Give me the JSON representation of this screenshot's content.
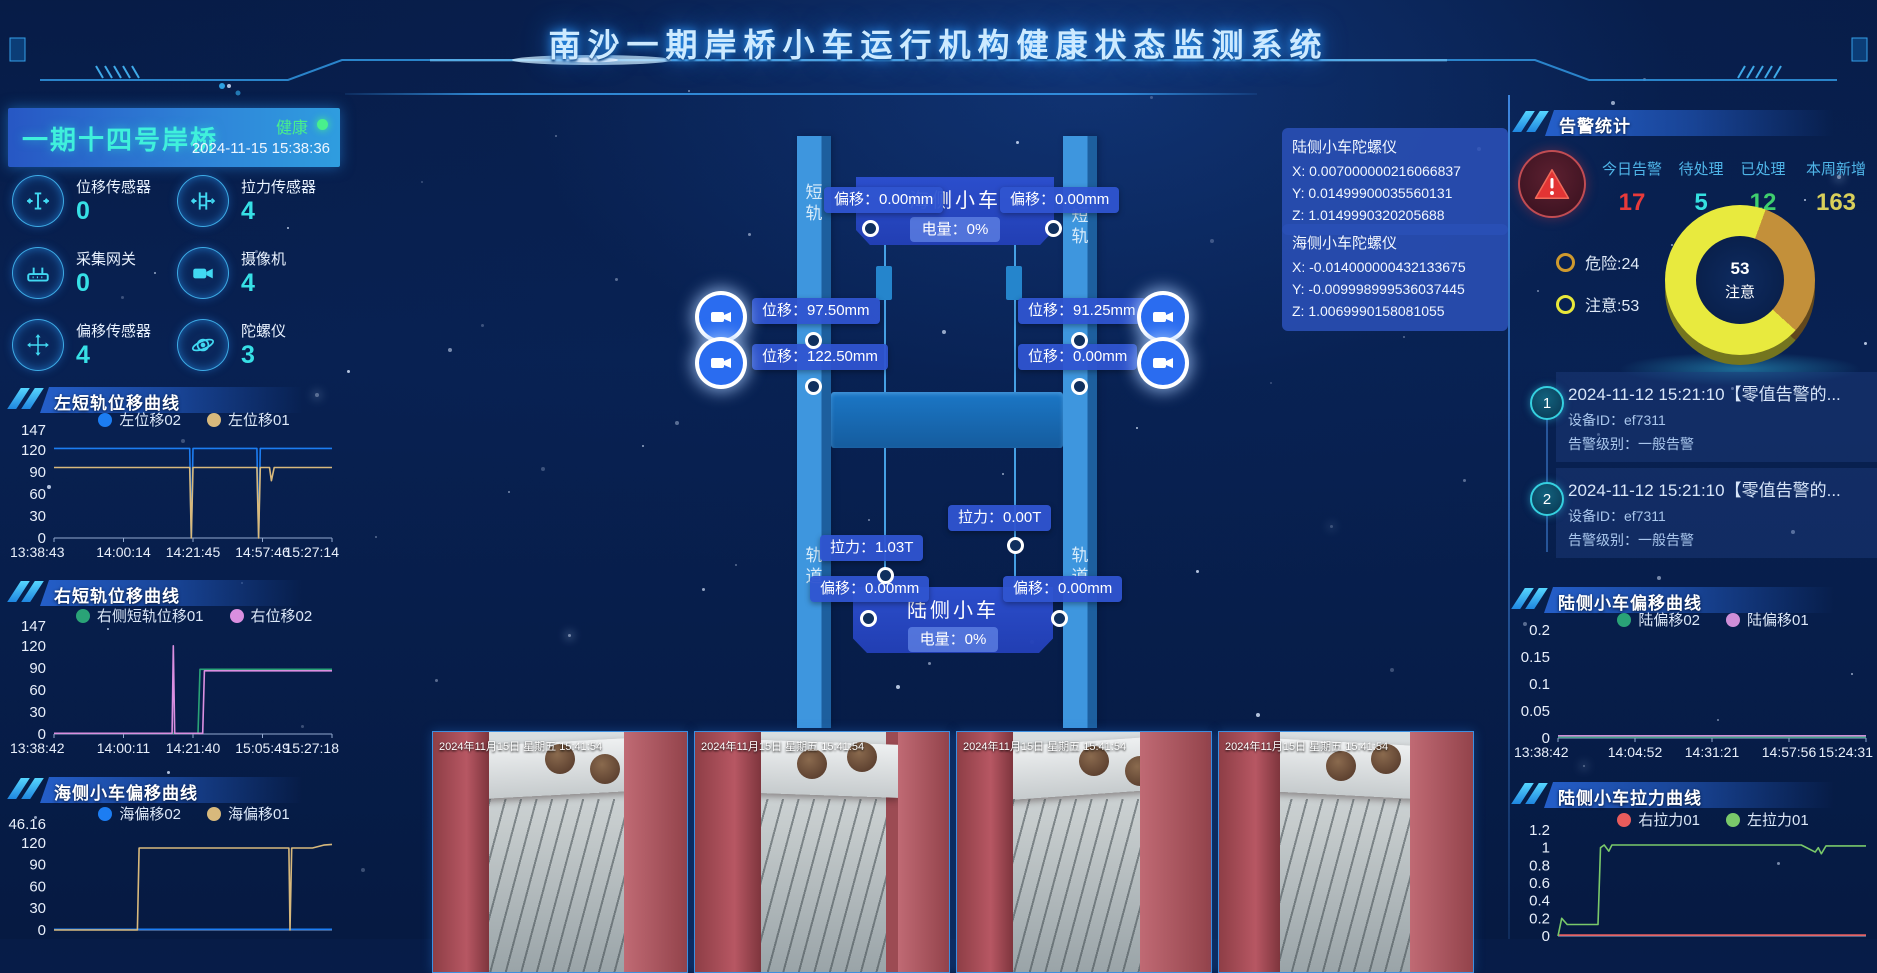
{
  "header": {
    "title": "南沙一期岸桥小车运行机构健康状态监测系统"
  },
  "crane": {
    "name": "一期十四号岸桥",
    "status": "健康",
    "timestamp": "2024-11-15 15:38:36",
    "sensors": [
      {
        "icon": "displacement-sensor-icon",
        "label": "位移传感器",
        "value": "0"
      },
      {
        "icon": "tension-sensor-icon",
        "label": "拉力传感器",
        "value": "4"
      },
      {
        "icon": "gateway-icon",
        "label": "采集网关",
        "value": "0"
      },
      {
        "icon": "camera-icon",
        "label": "摄像机",
        "value": "4"
      },
      {
        "icon": "offset-sensor-icon",
        "label": "偏移传感器",
        "value": "4"
      },
      {
        "icon": "gyroscope-icon",
        "label": "陀螺仪",
        "value": "3"
      }
    ]
  },
  "schematic": {
    "rail_short_label": "短\n轨",
    "rail_track_label": "轨\n道",
    "sea_trolley": {
      "name": "海侧小车",
      "battery": "电量：0%",
      "offset_left": "偏移：0.00mm",
      "offset_right": "偏移：0.00mm"
    },
    "land_trolley": {
      "name": "陆侧小车",
      "battery": "电量：0%",
      "offset_left": "偏移：0.00mm",
      "offset_right": "偏移：0.00mm"
    },
    "displacement": {
      "left_upper": "位移：97.50mm",
      "left_lower": "位移：122.50mm",
      "right_upper": "位移：91.25mm",
      "right_lower": "位移：0.00mm"
    },
    "tension": {
      "right": "拉力：0.00T",
      "left": "拉力：1.03T"
    },
    "gyros": [
      {
        "title": "陆侧小车陀螺仪",
        "x": "X:  0.007000000216066837",
        "y": "Y:  0.01499900035560131",
        "z": "Z:  1.0149990320205688"
      },
      {
        "title": "海侧小车陀螺仪",
        "x": "X:  -0.014000000432133675",
        "y": "Y:  -0.009998999536037445",
        "z": "Z:  1.0069990158081055"
      }
    ]
  },
  "alarms": {
    "title": "告警统计",
    "stats": [
      {
        "label": "今日告警",
        "value": "17",
        "color": "#e83a3a"
      },
      {
        "label": "待处理",
        "value": "5",
        "color": "#35e0e0"
      },
      {
        "label": "已处理",
        "value": "12",
        "color": "#3fcf6e"
      },
      {
        "label": "本周新增",
        "value": "163",
        "color": "#d8cf5a"
      }
    ],
    "items": [
      {
        "no": "1",
        "title": "2024-11-12 15:21:10【零值告警的...",
        "device": "设备ID：ef7311",
        "level": "告警级别：一般告警"
      },
      {
        "no": "2",
        "title": "2024-11-12 15:21:10【零值告警的...",
        "device": "设备ID：ef7311",
        "level": "告警级别：一般告警"
      }
    ]
  },
  "cameras": [
    {
      "timestamp": "2024年11月15日 星期五 15:41:54"
    },
    {
      "timestamp": "2024年11月15日 星期五 15:41:54"
    },
    {
      "timestamp": "2024年11月15日 星期五 15:41:54"
    },
    {
      "timestamp": "2024年11月15日 星期五 15:41:54"
    }
  ],
  "chart_data": [
    {
      "type": "line",
      "title": "左短轨位移曲线",
      "ylim": [
        0,
        147
      ],
      "yticks": [
        "147",
        "120",
        "90",
        "60",
        "30",
        "0"
      ],
      "xticks": [
        "13:38:43",
        "14:00:14",
        "14:21:45",
        "14:57:46",
        "15:27:14"
      ],
      "series": [
        {
          "name": "左位移02",
          "color": "#1c7df2",
          "points": [
            [
              0,
              122
            ],
            [
              0.488,
              122
            ],
            [
              0.494,
              2
            ],
            [
              0.5,
              122
            ],
            [
              0.73,
              122
            ],
            [
              0.736,
              2
            ],
            [
              0.742,
              122
            ],
            [
              1,
              122
            ]
          ]
        },
        {
          "name": "左位移01",
          "color": "#d8b97c",
          "points": [
            [
              0,
              96
            ],
            [
              0.488,
              96
            ],
            [
              0.494,
              0
            ],
            [
              0.5,
              96
            ],
            [
              0.73,
              96
            ],
            [
              0.736,
              0
            ],
            [
              0.742,
              96
            ],
            [
              0.775,
              96
            ],
            [
              0.782,
              78
            ],
            [
              0.792,
              96
            ],
            [
              1,
              96
            ]
          ]
        }
      ]
    },
    {
      "type": "line",
      "title": "右短轨位移曲线",
      "ylim": [
        0,
        147
      ],
      "yticks": [
        "147",
        "120",
        "90",
        "60",
        "30",
        "0"
      ],
      "xticks": [
        "13:38:42",
        "14:00:11",
        "14:21:40",
        "15:05:49",
        "15:27:18"
      ],
      "series": [
        {
          "name": "右侧短轨位移01",
          "color": "#2aa377",
          "points": [
            [
              0,
              1
            ],
            [
              0.518,
              1
            ],
            [
              0.525,
              88
            ],
            [
              1,
              88
            ]
          ]
        },
        {
          "name": "右位移02",
          "color": "#da8fe0",
          "points": [
            [
              0,
              1
            ],
            [
              0.425,
              1
            ],
            [
              0.429,
              120
            ],
            [
              0.434,
              1
            ],
            [
              0.535,
              1
            ],
            [
              0.541,
              86
            ],
            [
              1,
              86
            ]
          ]
        }
      ]
    },
    {
      "type": "line",
      "title": "海侧小车偏移曲线",
      "ylim": [
        0,
        146.16
      ],
      "yticks": [
        "146.16",
        "120",
        "90",
        "60",
        "30",
        "0"
      ],
      "xticks": [],
      "series": [
        {
          "name": "海偏移02",
          "color": "#1c7df2",
          "points": [
            [
              0,
              1
            ],
            [
              1,
              1
            ]
          ]
        },
        {
          "name": "海偏移01",
          "color": "#d8b97c",
          "points": [
            [
              0,
              0
            ],
            [
              0.3,
              0
            ],
            [
              0.306,
              113
            ],
            [
              0.845,
              113
            ],
            [
              0.849,
              0
            ],
            [
              0.855,
              113
            ],
            [
              0.93,
              113
            ],
            [
              0.97,
              117
            ],
            [
              1,
              118
            ]
          ]
        }
      ]
    },
    {
      "type": "line",
      "title": "陆侧小车偏移曲线",
      "ylim": [
        0,
        0.2
      ],
      "yticks": [
        "0.2",
        "0.15",
        "0.1",
        "0.05",
        "0"
      ],
      "xticks": [
        "13:38:42",
        "14:04:52",
        "14:31:21",
        "14:57:56",
        "15:24:31"
      ],
      "series": [
        {
          "name": "陆偏移02",
          "color": "#2aa377",
          "points": [
            [
              0,
              0.002
            ],
            [
              1,
              0.002
            ]
          ]
        },
        {
          "name": "陆偏移01",
          "color": "#cf8fd8",
          "points": [
            [
              0,
              0.004
            ],
            [
              1,
              0.004
            ]
          ]
        }
      ]
    },
    {
      "type": "line",
      "title": "陆侧小车拉力曲线",
      "ylim": [
        0,
        1.2
      ],
      "yticks": [
        "1.2",
        "1",
        "0.8",
        "0.6",
        "0.4",
        "0.2",
        "0"
      ],
      "xticks": [],
      "series": [
        {
          "name": "右拉力01",
          "color": "#e85c5c",
          "points": [
            [
              0,
              0.01
            ],
            [
              1,
              0.01
            ]
          ]
        },
        {
          "name": "左拉力01",
          "color": "#7ac96a",
          "points": [
            [
              0,
              0
            ],
            [
              0.012,
              0.2
            ],
            [
              0.03,
              0.13
            ],
            [
              0.13,
              0.13
            ],
            [
              0.138,
              1.0
            ],
            [
              0.15,
              1.03
            ],
            [
              0.165,
              0.96
            ],
            [
              0.175,
              1.03
            ],
            [
              0.79,
              1.03
            ],
            [
              0.835,
              0.95
            ],
            [
              0.845,
              1.0
            ],
            [
              0.855,
              0.93
            ],
            [
              0.87,
              1.02
            ],
            [
              1,
              1.02
            ]
          ]
        }
      ]
    },
    {
      "type": "pie",
      "slices": [
        {
          "label": "危险",
          "value": 24,
          "color": "#c3903a"
        },
        {
          "label": "注意",
          "value": 53,
          "color": "#e8ea3e"
        }
      ],
      "legend": [
        "危险:24",
        "注意:53"
      ],
      "center_value": "53",
      "center_label": "注意"
    }
  ]
}
